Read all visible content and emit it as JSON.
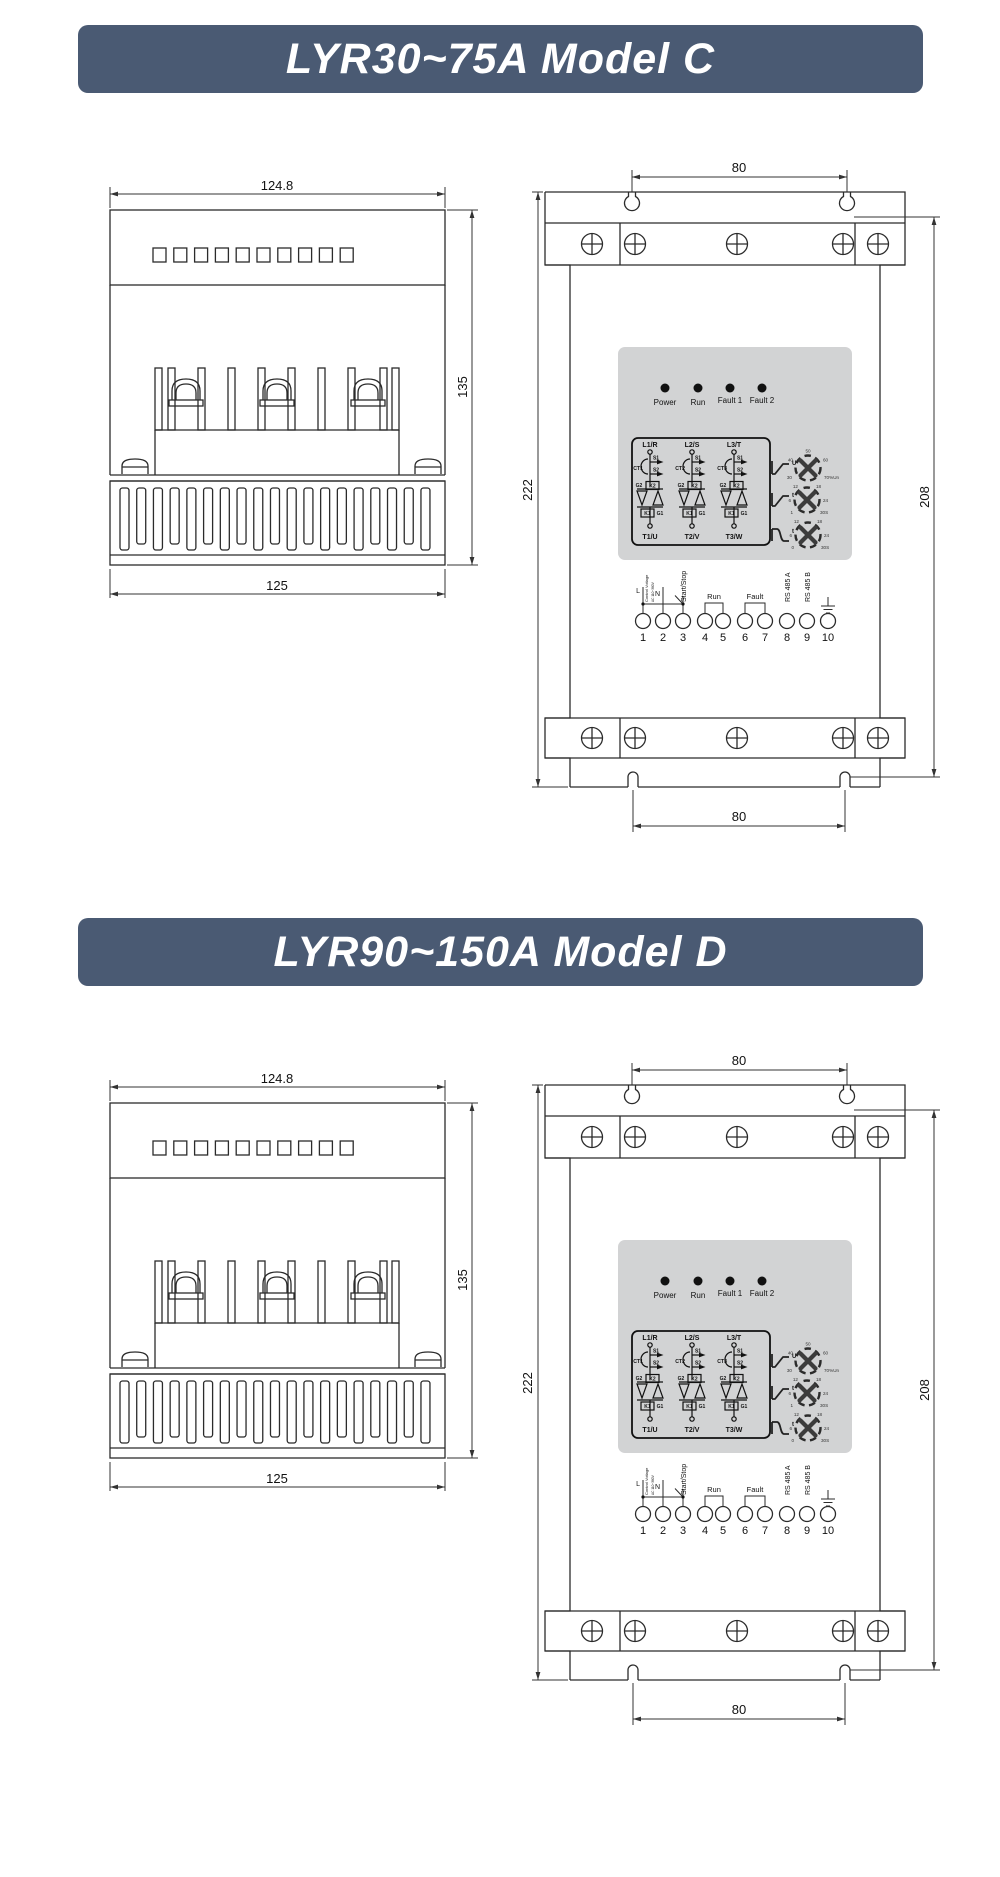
{
  "colors": {
    "banner_bg": "#4a5a73",
    "banner_text": "#ffffff",
    "panel_bg": "#d2d3d4",
    "line": "#2b2b2b"
  },
  "sections": [
    {
      "title": "LYR30~75A Model C"
    },
    {
      "title": "LYR90~150A Model D"
    }
  ],
  "side_view": {
    "dim_width_top": "124.8",
    "dim_height": "135",
    "dim_width_bottom": "125"
  },
  "front_view": {
    "dim_hole_spacing_top": "80",
    "dim_height": "222",
    "dim_hole_height": "208",
    "dim_hole_spacing_bottom": "80",
    "leds": [
      "Power",
      "Run",
      "Fault 1",
      "Fault 2"
    ],
    "circuit": {
      "inputs": [
        "L1/R",
        "L2/S",
        "L3/T"
      ],
      "outputs": [
        "T1/U",
        "T2/V",
        "T3/W"
      ],
      "cts": [
        "CT1",
        "CT2",
        "CT3"
      ],
      "taps": [
        "S1",
        "S2"
      ],
      "scr_top": [
        "G2",
        "K2"
      ],
      "scr_bottom": [
        "K1",
        "G1"
      ]
    },
    "dials": [
      {
        "name": "start-voltage",
        "axis_label": "U",
        "scale": {
          "top": "50",
          "left": "40",
          "right": "60",
          "bottom_left": "30",
          "bottom_right": "70%Un"
        }
      },
      {
        "name": "ramp-up-time",
        "axis_label": "t",
        "scale": {
          "top_left": "12",
          "top_right": "18",
          "left": "6",
          "right": "24",
          "bottom_left": "1",
          "bottom_right": "30S"
        }
      },
      {
        "name": "ramp-down-time",
        "axis_label": "t",
        "scale": {
          "top_left": "12",
          "top_right": "18",
          "left": "6",
          "right": "24",
          "bottom_left": "0",
          "bottom_right": "30S"
        }
      }
    ],
    "terminals": {
      "numbers": [
        "1",
        "2",
        "3",
        "4",
        "5",
        "6",
        "7",
        "8",
        "9",
        "10"
      ],
      "line": "L",
      "neutral": "N",
      "control_voltage": "Control Voltage",
      "control_voltage_sub": "AC 110~380V",
      "start_stop": "Start/Stop",
      "run": "Run",
      "fault": "Fault",
      "rs485_a": "RS 485 A",
      "rs485_b": "RS 485 B"
    }
  }
}
